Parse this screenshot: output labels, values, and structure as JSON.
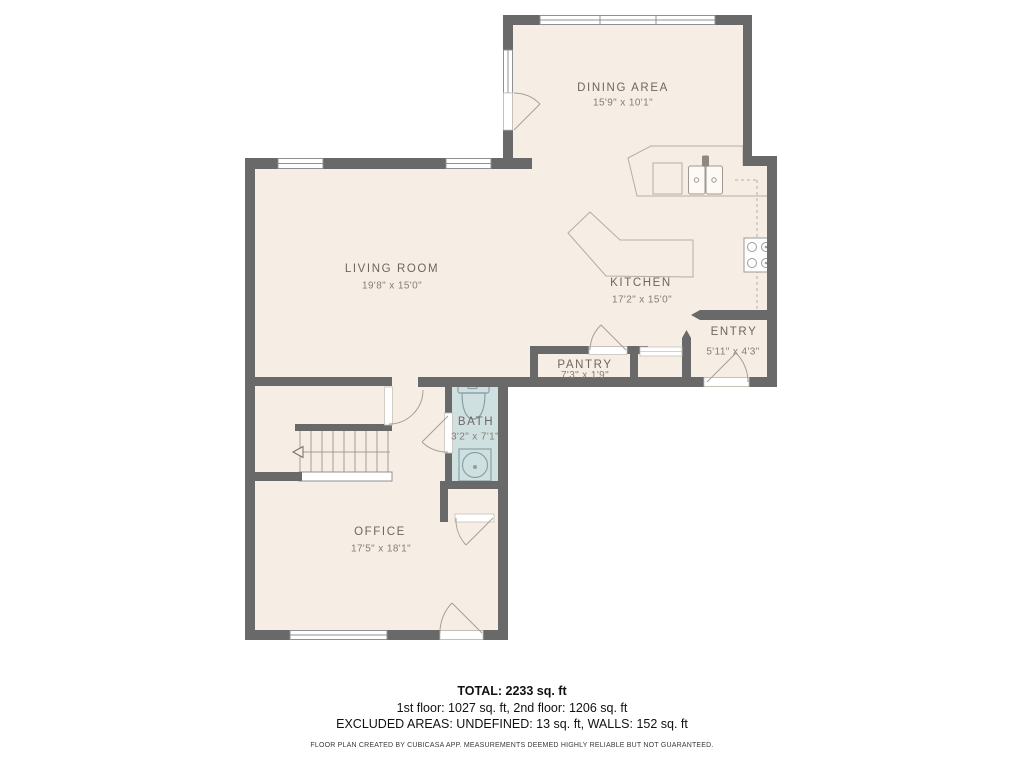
{
  "rooms": [
    {
      "name": "DINING AREA",
      "dims": "15'9\" x 10'1\""
    },
    {
      "name": "LIVING ROOM",
      "dims": "19'8\" x 15'0\""
    },
    {
      "name": "KITCHEN",
      "dims": "17'2\" x 15'0\""
    },
    {
      "name": "ENTRY",
      "dims": "5'11\" x 4'3\""
    },
    {
      "name": "PANTRY",
      "dims": "7'3\" x 1'9\""
    },
    {
      "name": "BATH",
      "dims": "3'2\" x 7'1\""
    },
    {
      "name": "OFFICE",
      "dims": "17'5\" x 18'1\""
    }
  ],
  "summary": {
    "total": "TOTAL: 2233 sq. ft",
    "floors": "1st floor: 1027 sq. ft, 2nd floor: 1206 sq. ft",
    "excluded": "EXCLUDED AREAS: UNDEFINED: 13 sq. ft, WALLS: 152 sq. ft",
    "disclaimer": "FLOOR PLAN CREATED BY CUBICASA APP. MEASUREMENTS DEEMED HIGHLY RELIABLE BUT NOT GUARANTEED."
  },
  "colors": {
    "wall": "#696969",
    "floor": "#f6eee4",
    "bath_floor": "#cfe0e1",
    "furniture_line": "#b5ada2",
    "label_text": "#6e675f",
    "summary_text": "#111111"
  }
}
